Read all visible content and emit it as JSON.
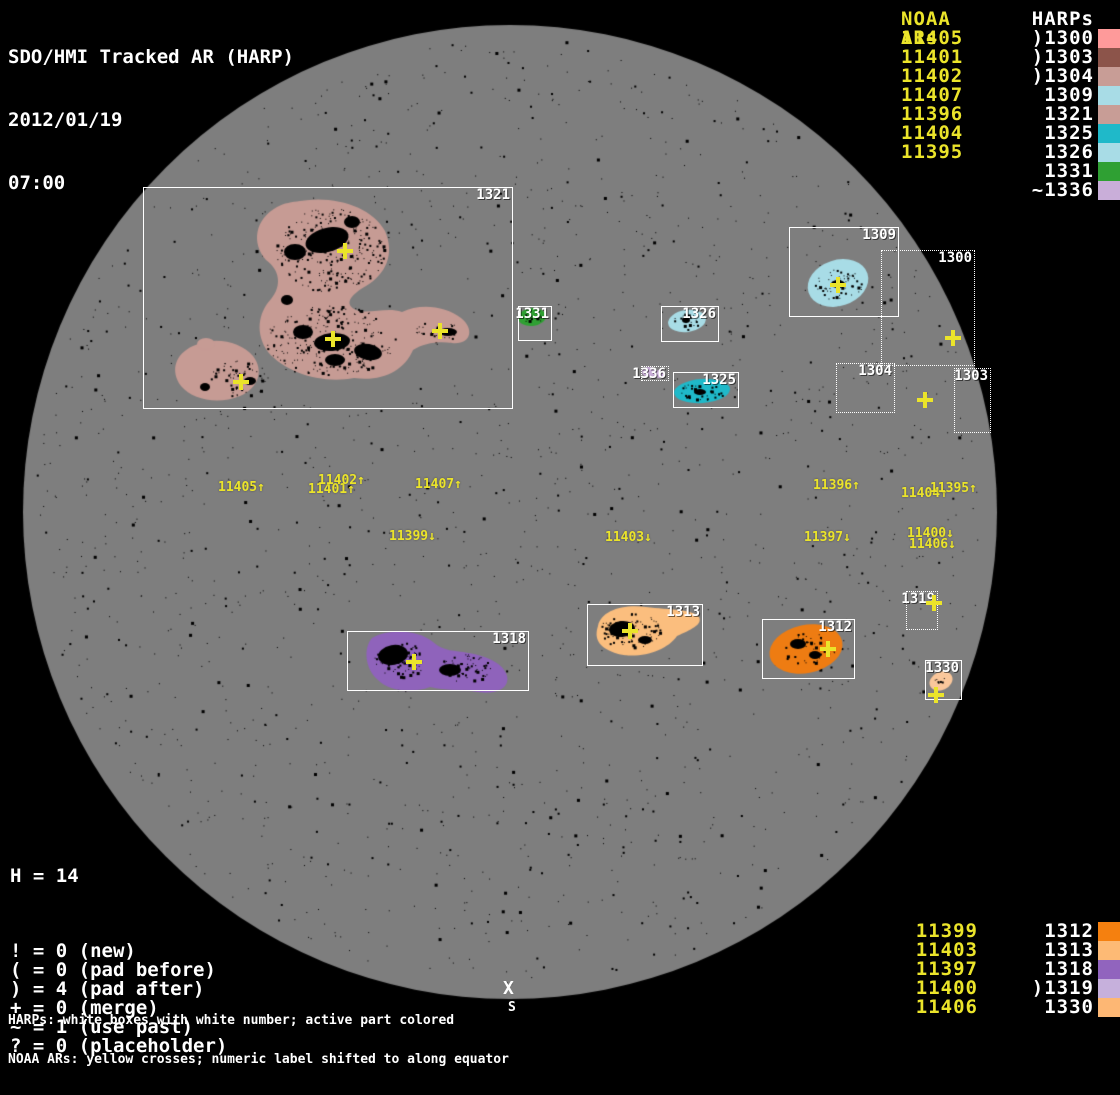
{
  "header": {
    "title": "SDO/HMI Tracked AR (HARP)",
    "date": "2012/01/19",
    "time": "07:00"
  },
  "colors": {
    "background": "#000000",
    "disk": "#7E7E7E",
    "yellow": "#EBE42A",
    "white": "#FFFFFF"
  },
  "top_legend": {
    "noaa_header": "NOAA ARs",
    "harps_header": "HARPs",
    "rows": [
      {
        "noaa": "11405",
        "harp": ")1300",
        "swatch": "#FE9A9A"
      },
      {
        "noaa": "11401",
        "harp": ")1303",
        "swatch": "#8C544A"
      },
      {
        "noaa": "11402",
        "harp": ")1304",
        "swatch": "#C89D96"
      },
      {
        "noaa": "11407",
        "harp": "1309",
        "swatch": "#A8DCE6"
      },
      {
        "noaa": "11396",
        "harp": "1321",
        "swatch": "#C89D96"
      },
      {
        "noaa": "11404",
        "harp": "1325",
        "swatch": "#1FB9C9"
      },
      {
        "noaa": "11395",
        "harp": "1326",
        "swatch": "#A8DCE6"
      },
      {
        "noaa": "",
        "harp": "1331",
        "swatch": "#2FA033"
      },
      {
        "noaa": "",
        "harp": "~1336",
        "swatch": "#C9AED9"
      }
    ]
  },
  "bottom_legend": {
    "rows": [
      {
        "noaa": "11399",
        "harp": "1312",
        "swatch": "#F5800F"
      },
      {
        "noaa": "11403",
        "harp": "1313",
        "swatch": "#FDBA75"
      },
      {
        "noaa": "11397",
        "harp": "1318",
        "swatch": "#9164BE"
      },
      {
        "noaa": "11400",
        "harp": ")1319",
        "swatch": "#C6B0DC"
      },
      {
        "noaa": "11406",
        "harp": "1330",
        "swatch": "#FDB774"
      }
    ]
  },
  "stats": {
    "harp_count": "H = 14",
    "flags": [
      "! = 0 (new)",
      "( = 0 (pad before)",
      ") = 4 (pad after)",
      "+ = 0 (merge)",
      "~ = 1 (use past)",
      "? = 0 (placeholder)"
    ]
  },
  "captions": {
    "line1": "HARPs: white boxes with white number; active part colored",
    "line2": "NOAA ARs: yellow crosses; numeric label shifted to along equator"
  },
  "south_marker": {
    "symbol": "X",
    "label": "S"
  },
  "chart_data": {
    "type": "scatter",
    "title": "SDO/HMI Tracked AR (HARP)",
    "timestamp": "2012/01/19 07:00",
    "harp_count": 14,
    "flag_counts": {
      "new": 0,
      "pad_before": 0,
      "pad_after": 4,
      "merge": 0,
      "use_past": 1,
      "placeholder": 0
    },
    "noaa_harp_pairs": [
      {
        "noaa": "11405",
        "harp": ")1300",
        "color": "#FE9A9A"
      },
      {
        "noaa": "11401",
        "harp": ")1303",
        "color": "#8C544A"
      },
      {
        "noaa": "11402",
        "harp": ")1304",
        "color": "#C89D96"
      },
      {
        "noaa": "11407",
        "harp": "1309",
        "color": "#A8DCE6"
      },
      {
        "noaa": "11396",
        "harp": "1321",
        "color": "#C89D96"
      },
      {
        "noaa": "11404",
        "harp": "1325",
        "color": "#1FB9C9"
      },
      {
        "noaa": "11395",
        "harp": "1326",
        "color": "#A8DCE6"
      },
      {
        "noaa": "",
        "harp": "1331",
        "color": "#2FA033"
      },
      {
        "noaa": "",
        "harp": "~1336",
        "color": "#C9AED9"
      },
      {
        "noaa": "11399",
        "harp": "1312",
        "color": "#F5800F"
      },
      {
        "noaa": "11403",
        "harp": "1313",
        "color": "#FDBA75"
      },
      {
        "noaa": "11397",
        "harp": "1318",
        "color": "#9164BE"
      },
      {
        "noaa": "11400",
        "harp": ")1319",
        "color": "#C6B0DC"
      },
      {
        "noaa": "11406",
        "harp": "1330",
        "color": "#FDB774"
      }
    ]
  },
  "map": {
    "disk": {
      "cx": 510,
      "cy": 512,
      "r": 487
    },
    "global_speckles": {
      "count": 1700,
      "seed": 77
    },
    "boxes": [
      {
        "label": "1321",
        "x": 143,
        "y": 187,
        "w": 370,
        "h": 222,
        "style": "solid"
      },
      {
        "label": "1309",
        "x": 789,
        "y": 227,
        "w": 110,
        "h": 90,
        "style": "solid"
      },
      {
        "label": "1300",
        "x": 881,
        "y": 250,
        "w": 94,
        "h": 116,
        "style": "dotted"
      },
      {
        "label": "1304",
        "x": 836,
        "y": 363,
        "w": 59,
        "h": 50,
        "style": "dotted"
      },
      {
        "label": "1303",
        "x": 954,
        "y": 368,
        "w": 37,
        "h": 65,
        "style": "dotted"
      },
      {
        "label": "1331",
        "x": 518,
        "y": 306,
        "w": 34,
        "h": 35,
        "style": "solid"
      },
      {
        "label": "1326",
        "x": 661,
        "y": 306,
        "w": 58,
        "h": 36,
        "style": "solid"
      },
      {
        "label": "1336",
        "x": 641,
        "y": 366,
        "w": 28,
        "h": 15,
        "style": "dotted"
      },
      {
        "label": "1325",
        "x": 673,
        "y": 372,
        "w": 66,
        "h": 36,
        "style": "solid"
      },
      {
        "label": "1318",
        "x": 347,
        "y": 631,
        "w": 182,
        "h": 60,
        "style": "solid"
      },
      {
        "label": "1313",
        "x": 587,
        "y": 604,
        "w": 116,
        "h": 62,
        "style": "solid"
      },
      {
        "label": "1312",
        "x": 762,
        "y": 619,
        "w": 93,
        "h": 60,
        "style": "solid"
      },
      {
        "label": "1319",
        "x": 906,
        "y": 591,
        "w": 32,
        "h": 39,
        "style": "dotted"
      },
      {
        "label": "1330",
        "x": 925,
        "y": 660,
        "w": 37,
        "h": 40,
        "style": "solid"
      }
    ],
    "crosses": [
      [
        345,
        251
      ],
      [
        333,
        339
      ],
      [
        440,
        331
      ],
      [
        241,
        382
      ],
      [
        838,
        285
      ],
      [
        953,
        338
      ],
      [
        925,
        400
      ],
      [
        934,
        603
      ],
      [
        828,
        649
      ],
      [
        630,
        631
      ],
      [
        414,
        662
      ],
      [
        936,
        695
      ]
    ],
    "labels": [
      {
        "text": "11405↑",
        "x": 218,
        "y": 481
      },
      {
        "text": "11401↑",
        "x": 308,
        "y": 483
      },
      {
        "text": "11402↑",
        "x": 318,
        "y": 474
      },
      {
        "text": "11407↑",
        "x": 415,
        "y": 478
      },
      {
        "text": "11399↓",
        "x": 389,
        "y": 530
      },
      {
        "text": "11403↓",
        "x": 605,
        "y": 531
      },
      {
        "text": "11396↑",
        "x": 813,
        "y": 479
      },
      {
        "text": "11404↑",
        "x": 901,
        "y": 487
      },
      {
        "text": "11395↑",
        "x": 930,
        "y": 482
      },
      {
        "text": "11397↓",
        "x": 804,
        "y": 531
      },
      {
        "text": "11400↓",
        "x": 907,
        "y": 527
      },
      {
        "text": "11406↓",
        "x": 909,
        "y": 538
      }
    ],
    "blobs": [
      {
        "harp": "1321",
        "color": "#C69B94",
        "shapes": [
          {
            "type": "path",
            "d": "M300,201 C335,195 372,207 385,231 C395,254 386,274 366,286 C352,294 344,303 354,309 C366,316 386,306 402,312 C420,303 446,306 461,318 C475,329 471,345 452,343 C438,341 424,343 413,350 C404,371 382,382 354,378 C322,384 286,373 268,352 C255,334 258,313 271,299 C282,286 280,270 266,260 C251,243 255,219 277,207 C284,203 292,202 300,201 Z"
          },
          {
            "type": "path",
            "d": "M193,346 C214,336 240,341 253,356 C264,370 259,388 240,396 C218,405 193,400 181,386 C170,371 175,354 193,346 Z"
          },
          {
            "type": "ellipse",
            "cx": 206,
            "cy": 344,
            "rx": 9,
            "ry": 6,
            "rot": 0
          }
        ]
      },
      {
        "harp": "1309",
        "color": "#A8DCE6",
        "shapes": [
          {
            "type": "ellipse",
            "cx": 838,
            "cy": 283,
            "rx": 31,
            "ry": 23,
            "rot": -18
          }
        ]
      },
      {
        "harp": "1326",
        "color": "#A8DCE6",
        "shapes": [
          {
            "type": "ellipse",
            "cx": 687,
            "cy": 321,
            "rx": 19,
            "ry": 11,
            "rot": -8
          }
        ]
      },
      {
        "harp": "1325",
        "color": "#1FB9C9",
        "shapes": [
          {
            "type": "ellipse",
            "cx": 702,
            "cy": 391,
            "rx": 28,
            "ry": 12,
            "rot": -4
          }
        ]
      },
      {
        "harp": "1331",
        "color": "#2FA033",
        "shapes": [
          {
            "type": "ellipse",
            "cx": 532,
            "cy": 317,
            "rx": 14,
            "ry": 9,
            "rot": -6
          }
        ]
      },
      {
        "harp": "1336",
        "color": "#C9AED9",
        "shapes": [
          {
            "type": "ellipse",
            "cx": 649,
            "cy": 372,
            "rx": 7,
            "ry": 5,
            "rot": 0
          },
          {
            "type": "ellipse",
            "cx": 659,
            "cy": 374,
            "rx": 6,
            "ry": 4,
            "rot": 0
          }
        ]
      },
      {
        "harp": "1318",
        "color": "#8F63BB",
        "shapes": [
          {
            "type": "path",
            "d": "M372,638 C390,628 418,630 433,642 C444,652 455,650 468,653 C488,656 504,664 507,676 C510,688 496,695 478,692 C460,689 446,691 430,687 C411,694 389,691 378,680 C365,669 363,648 372,638 Z"
          }
        ]
      },
      {
        "harp": "1313",
        "color": "#FBBE7E",
        "shapes": [
          {
            "type": "path",
            "d": "M598,626 C601,611 622,604 646,607 C670,610 692,609 699,617 C703,625 690,630 677,636 C666,652 637,660 615,653 C598,647 594,638 598,626 Z"
          }
        ]
      },
      {
        "harp": "1312",
        "color": "#EE7C12",
        "shapes": [
          {
            "type": "ellipse",
            "cx": 806,
            "cy": 649,
            "rx": 37,
            "ry": 24,
            "rot": -12
          }
        ]
      },
      {
        "harp": "1330",
        "color": "#FAC79B",
        "shapes": [
          {
            "type": "ellipse",
            "cx": 941,
            "cy": 681,
            "rx": 12,
            "ry": 9,
            "rot": -25
          }
        ]
      }
    ],
    "sunspots": [
      {
        "cx": 327,
        "cy": 240,
        "rx": 22,
        "ry": 12,
        "rot": -15
      },
      {
        "cx": 295,
        "cy": 252,
        "rx": 11,
        "ry": 8,
        "rot": 0
      },
      {
        "cx": 352,
        "cy": 222,
        "rx": 8,
        "ry": 6,
        "rot": 0
      },
      {
        "cx": 332,
        "cy": 342,
        "rx": 18,
        "ry": 9,
        "rot": -5
      },
      {
        "cx": 303,
        "cy": 332,
        "rx": 10,
        "ry": 7,
        "rot": 0
      },
      {
        "cx": 368,
        "cy": 352,
        "rx": 14,
        "ry": 8,
        "rot": 10
      },
      {
        "cx": 335,
        "cy": 360,
        "rx": 10,
        "ry": 6,
        "rot": 0
      },
      {
        "cx": 448,
        "cy": 332,
        "rx": 9,
        "ry": 4,
        "rot": 0
      },
      {
        "cx": 250,
        "cy": 381,
        "rx": 6,
        "ry": 4,
        "rot": 0
      },
      {
        "cx": 205,
        "cy": 387,
        "rx": 5,
        "ry": 4,
        "rot": 0
      },
      {
        "cx": 287,
        "cy": 300,
        "rx": 6,
        "ry": 5,
        "rot": 0
      },
      {
        "cx": 393,
        "cy": 655,
        "rx": 15,
        "ry": 10,
        "rot": -10
      },
      {
        "cx": 450,
        "cy": 670,
        "rx": 11,
        "ry": 6,
        "rot": 0
      },
      {
        "cx": 622,
        "cy": 629,
        "rx": 13,
        "ry": 8,
        "rot": -5
      },
      {
        "cx": 645,
        "cy": 640,
        "rx": 7,
        "ry": 4,
        "rot": 0
      },
      {
        "cx": 798,
        "cy": 644,
        "rx": 8,
        "ry": 5,
        "rot": 0
      },
      {
        "cx": 815,
        "cy": 655,
        "rx": 6,
        "ry": 4,
        "rot": 0
      },
      {
        "cx": 838,
        "cy": 284,
        "rx": 7,
        "ry": 4,
        "rot": 0
      },
      {
        "cx": 700,
        "cy": 392,
        "rx": 6,
        "ry": 3,
        "rot": 0
      },
      {
        "cx": 686,
        "cy": 320,
        "rx": 4,
        "ry": 3,
        "rot": 0
      }
    ],
    "speckle_clusters": [
      {
        "cx": 330,
        "cy": 250,
        "rx": 55,
        "ry": 42,
        "n": 260
      },
      {
        "cx": 330,
        "cy": 340,
        "rx": 65,
        "ry": 35,
        "n": 260
      },
      {
        "cx": 240,
        "cy": 378,
        "rx": 30,
        "ry": 18,
        "n": 60
      },
      {
        "cx": 438,
        "cy": 330,
        "rx": 25,
        "ry": 10,
        "n": 30
      },
      {
        "cx": 838,
        "cy": 284,
        "rx": 24,
        "ry": 17,
        "n": 55
      },
      {
        "cx": 687,
        "cy": 321,
        "rx": 14,
        "ry": 8,
        "n": 20
      },
      {
        "cx": 702,
        "cy": 391,
        "rx": 22,
        "ry": 9,
        "n": 35
      },
      {
        "cx": 532,
        "cy": 317,
        "rx": 10,
        "ry": 6,
        "n": 10
      },
      {
        "cx": 400,
        "cy": 660,
        "rx": 26,
        "ry": 18,
        "n": 95
      },
      {
        "cx": 465,
        "cy": 668,
        "rx": 26,
        "ry": 14,
        "n": 60
      },
      {
        "cx": 630,
        "cy": 630,
        "rx": 30,
        "ry": 18,
        "n": 85
      },
      {
        "cx": 808,
        "cy": 648,
        "rx": 28,
        "ry": 16,
        "n": 45
      },
      {
        "cx": 941,
        "cy": 682,
        "rx": 8,
        "ry": 5,
        "n": 7
      }
    ]
  }
}
